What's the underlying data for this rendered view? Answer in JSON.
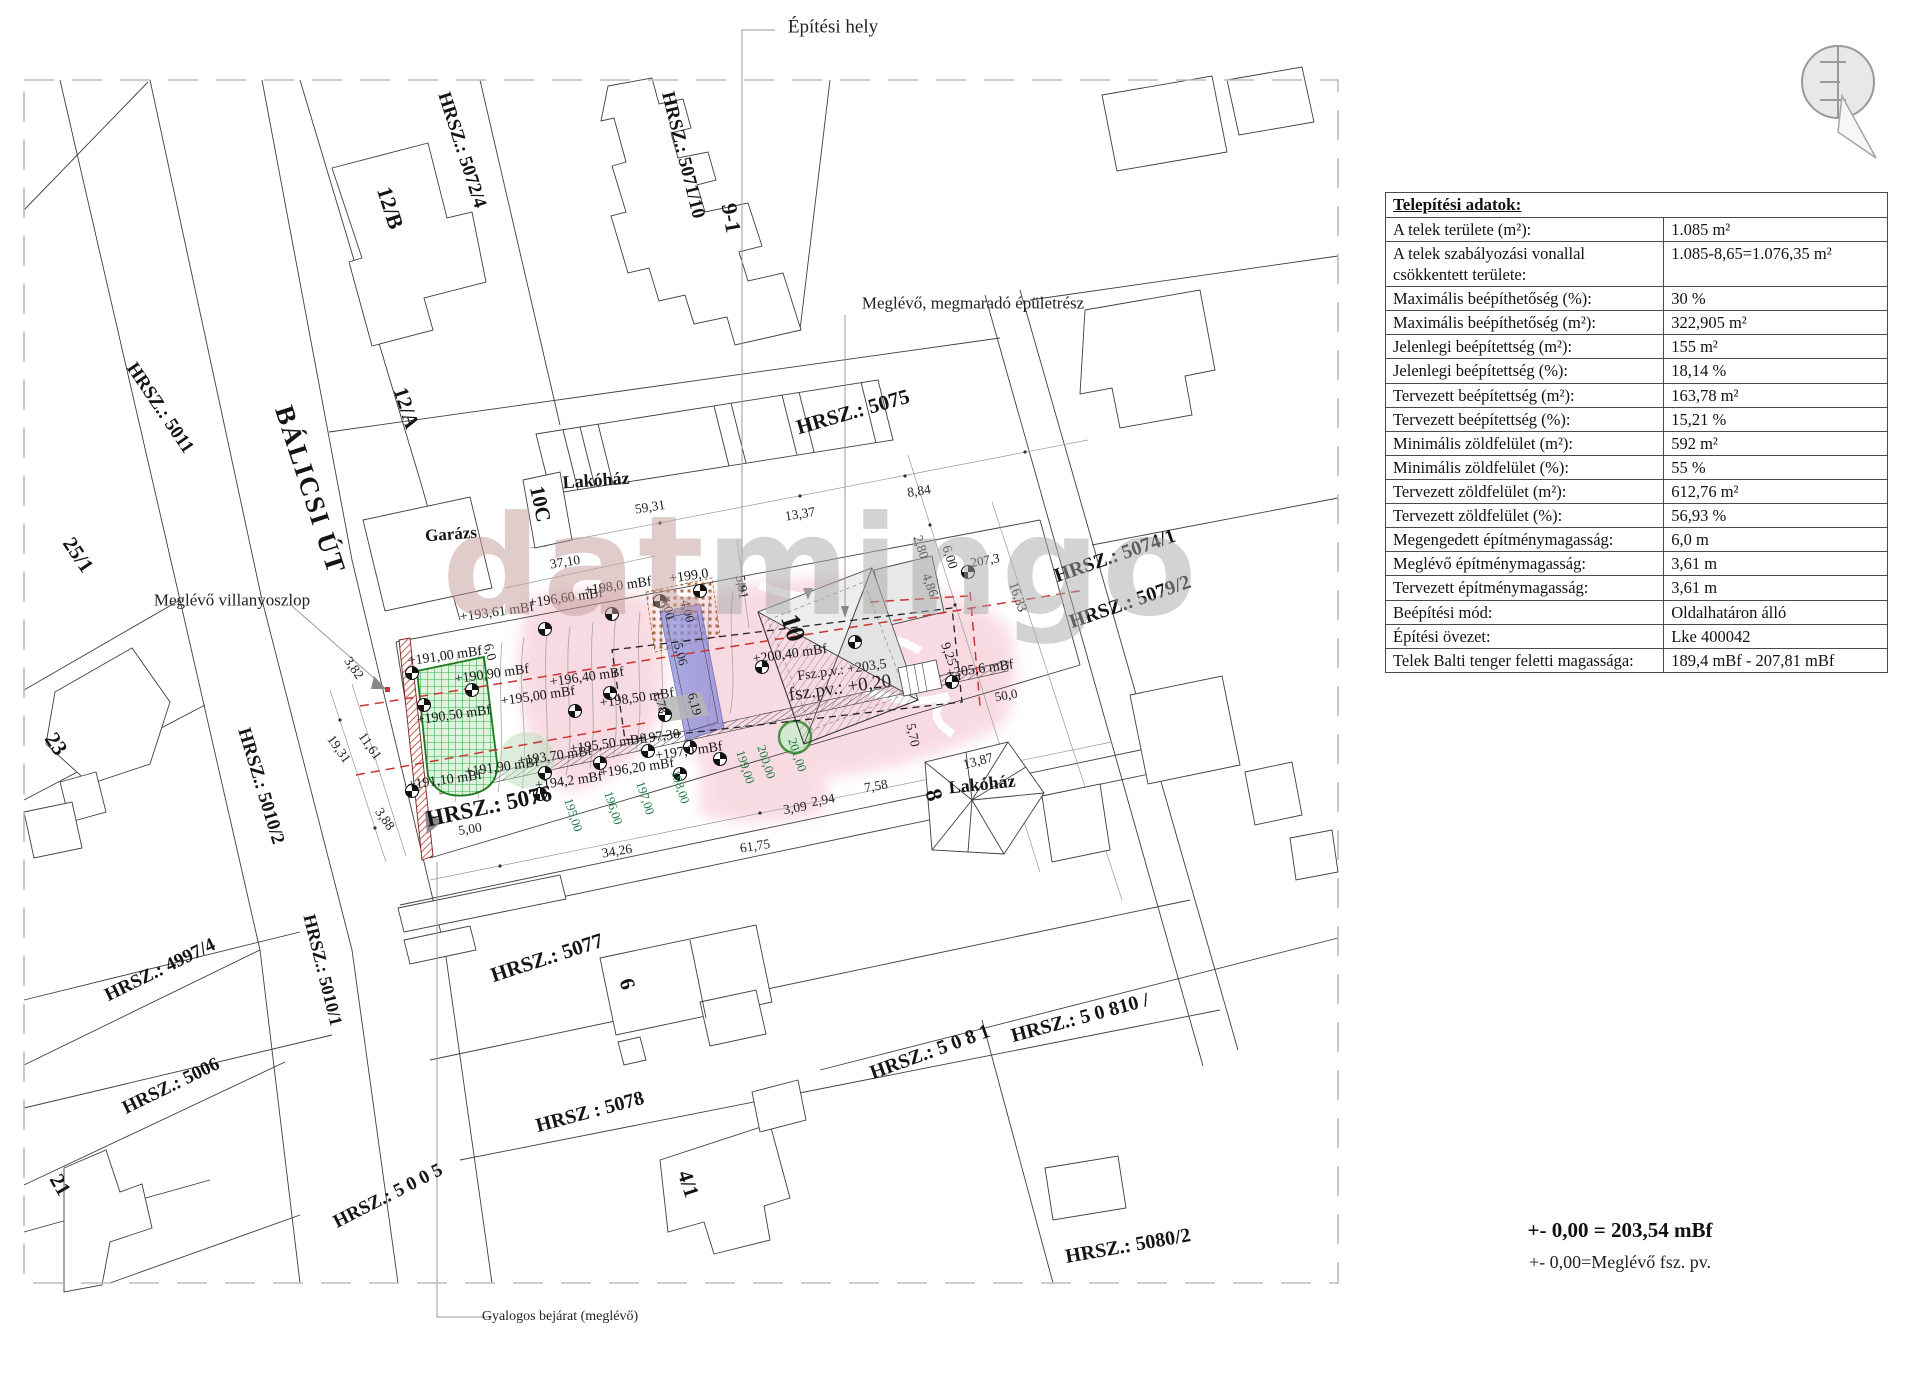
{
  "page": {
    "width": 1920,
    "height": 1376,
    "background": "#ffffff"
  },
  "colors": {
    "pink_zone": "#f3b9c6",
    "pool_blue": "#8c8cd9",
    "green_grid": "#2fae4a",
    "green_bg": "#dff3df",
    "wall_red": "#c0392b",
    "red_dash": "#cc3333",
    "contour_green": "#1e7a46",
    "watermark_gray": "#a8a8a8",
    "watermark_red": "#c49a9a",
    "line_gray": "#3f3f3f"
  },
  "watermark": {
    "part1": "dat",
    "part2": "mingo"
  },
  "footer": {
    "line1": "+- 0,00 = 203,54 mBf",
    "line2": "+- 0,00=Meglévő fsz. pv."
  },
  "table": {
    "title": "Telepítési adatok:",
    "rows": [
      {
        "label": "A telek területe (m²):",
        "value": "1.085 m²"
      },
      {
        "label": "A telek szabályozási vonallal csökkentett területe:",
        "value": "1.085-8,65=1.076,35 m²"
      },
      {
        "label": "Maximális beépíthetőség (%):",
        "value": "30 %"
      },
      {
        "label": "Maximális beépíthetőség (m²):",
        "value": "322,905 m²"
      },
      {
        "label": "Jelenlegi beépítettség (m²):",
        "value": "155 m²"
      },
      {
        "label": "Jelenlegi beépítettség (%):",
        "value": "18,14 %"
      },
      {
        "label": "Tervezett beépítettség (m²):",
        "value": "163,78 m²"
      },
      {
        "label": "Tervezett beépítettség (%):",
        "value": "15,21 %"
      },
      {
        "label": "Minimális zöldfelület (m²):",
        "value": "592 m²"
      },
      {
        "label": "Minimális zöldfelület (%):",
        "value": "55 %"
      },
      {
        "label": "Tervezett zöldfelület (m²):",
        "value": "612,76 m²"
      },
      {
        "label": "Tervezett zöldfelület (%):",
        "value": "56,93 %"
      },
      {
        "label": "Megengedett építménymagasság:",
        "value": "6,0 m"
      },
      {
        "label": "Meglévő építménymagasság:",
        "value": "3,61 m"
      },
      {
        "label": "Tervezett építménymagasság:",
        "value": "3,61 m"
      },
      {
        "label": "Beépítési mód:",
        "value": "Oldalhatáron álló"
      },
      {
        "label": "Építési övezet:",
        "value": "Lke 400042"
      },
      {
        "label": "Telek Balti tenger feletti magassága:",
        "value": "189,4 mBf  - 207,81 mBf"
      }
    ]
  },
  "map": {
    "parcel_labels": [
      {
        "t": "HRSZ.: 5072/4",
        "x": 462,
        "y": 150,
        "r": 72,
        "s": 19
      },
      {
        "t": "12/B",
        "x": 390,
        "y": 208,
        "r": 72,
        "s": 22
      },
      {
        "t": "HRSZ.: 5071/10",
        "x": 683,
        "y": 155,
        "r": 76,
        "s": 19
      },
      {
        "t": "9-1",
        "x": 731,
        "y": 218,
        "r": 80,
        "s": 22
      },
      {
        "t": "HRSZ.: 5011",
        "x": 160,
        "y": 408,
        "r": 56,
        "s": 19
      },
      {
        "t": "BÁLICSI ÚT",
        "x": 310,
        "y": 490,
        "r": 72,
        "s": 27,
        "sp": 2
      },
      {
        "t": "12/A",
        "x": 406,
        "y": 408,
        "r": 72,
        "s": 21
      },
      {
        "t": "25/1",
        "x": 78,
        "y": 555,
        "r": 56,
        "s": 21
      },
      {
        "t": "23",
        "x": 56,
        "y": 744,
        "r": 56,
        "s": 22
      },
      {
        "t": "21",
        "x": 60,
        "y": 1185,
        "r": 60,
        "s": 21
      },
      {
        "t": "HRSZ.: 5075",
        "x": 853,
        "y": 412,
        "r": -16,
        "s": 21
      },
      {
        "t": "HRSZ.: 5074/1",
        "x": 1115,
        "y": 556,
        "r": -19,
        "s": 20
      },
      {
        "t": "HRSZ.: 5079/2",
        "x": 1130,
        "y": 602,
        "r": -19,
        "s": 20
      },
      {
        "t": "HRSZ.: 5010/2",
        "x": 261,
        "y": 786,
        "r": 73,
        "s": 19
      },
      {
        "t": "HRSZ.: 4997/4",
        "x": 160,
        "y": 970,
        "r": -26,
        "s": 19
      },
      {
        "t": "HRSZ.: 5010/1",
        "x": 323,
        "y": 970,
        "r": 76,
        "s": 18
      },
      {
        "t": "HRSZ.: 5006",
        "x": 171,
        "y": 1086,
        "r": -26,
        "s": 19
      },
      {
        "t": "HRSZ.: 5 0 0 5",
        "x": 388,
        "y": 1196,
        "r": -27,
        "s": 19
      },
      {
        "t": "HRSZ.: 5076",
        "x": 489,
        "y": 806,
        "r": -12,
        "s": 23
      },
      {
        "t": "HRSZ.: 5077",
        "x": 547,
        "y": 958,
        "r": -18,
        "s": 21
      },
      {
        "t": "HRSZ : 5078",
        "x": 590,
        "y": 1112,
        "r": -15,
        "s": 20
      },
      {
        "t": "6",
        "x": 627,
        "y": 984,
        "r": 72,
        "s": 21
      },
      {
        "t": "4/1",
        "x": 688,
        "y": 1184,
        "r": 72,
        "s": 21
      },
      {
        "t": "HRSZ.: 5 0 8 1",
        "x": 930,
        "y": 1052,
        "r": -20,
        "s": 20
      },
      {
        "t": "HRSZ.: 5 0 810 /",
        "x": 1080,
        "y": 1018,
        "r": -15,
        "s": 20
      },
      {
        "t": "HRSZ.: 5080/2",
        "x": 1128,
        "y": 1246,
        "r": -10,
        "s": 20
      },
      {
        "t": "Lakóház",
        "x": 596,
        "y": 480,
        "r": -4,
        "s": 18
      },
      {
        "t": "Garázs",
        "x": 451,
        "y": 534,
        "r": -4,
        "s": 17
      },
      {
        "t": "10C",
        "x": 540,
        "y": 504,
        "r": 78,
        "s": 21
      },
      {
        "t": "Lakóház",
        "x": 982,
        "y": 784,
        "r": -6,
        "s": 18
      },
      {
        "t": "8",
        "x": 934,
        "y": 795,
        "r": 74,
        "s": 23
      },
      {
        "t": "10",
        "x": 793,
        "y": 628,
        "r": 72,
        "s": 27
      }
    ],
    "annotations": [
      {
        "t": "Építési hely",
        "x": 833,
        "y": 27,
        "s": 19
      },
      {
        "t": "Meglévő, megmaradó épületrész",
        "x": 973,
        "y": 303,
        "s": 17
      },
      {
        "t": "Meglévő villanyoszlop",
        "x": 232,
        "y": 600,
        "s": 17
      },
      {
        "t": "Gyalogos bejárat (meglévő)",
        "x": 560,
        "y": 1317,
        "s": 14
      },
      {
        "t": "Fsz.p.v.: +203,5",
        "x": 842,
        "y": 671,
        "r": -8,
        "s": 14
      },
      {
        "t": "fsz.pv.: +0,20",
        "x": 840,
        "y": 688,
        "r": -8,
        "s": 19
      }
    ],
    "elevations": [
      {
        "t": "+193,61 mBf",
        "x": 497,
        "y": 613,
        "r": -8,
        "s": 14
      },
      {
        "t": "+196,60 mBf",
        "x": 566,
        "y": 599,
        "r": -8,
        "s": 14
      },
      {
        "t": "+198,0 mBf",
        "x": 618,
        "y": 587,
        "r": -8,
        "s": 14
      },
      {
        "t": "+199,0",
        "x": 689,
        "y": 577,
        "r": -8,
        "s": 14
      },
      {
        "t": "+191,00 mBf",
        "x": 445,
        "y": 657,
        "r": -8,
        "s": 14
      },
      {
        "t": "+190,90 mBf",
        "x": 492,
        "y": 675,
        "r": -8,
        "s": 14
      },
      {
        "t": "+195,00 mBf",
        "x": 538,
        "y": 697,
        "r": -8,
        "s": 14
      },
      {
        "t": "+196,40 mBf",
        "x": 587,
        "y": 678,
        "r": -8,
        "s": 14
      },
      {
        "t": "+198,50 mBf",
        "x": 637,
        "y": 699,
        "r": -8,
        "s": 14
      },
      {
        "t": "+190,50 mBf",
        "x": 454,
        "y": 716,
        "r": -8,
        "s": 14
      },
      {
        "t": "+200,40 mBf",
        "x": 790,
        "y": 655,
        "r": -8,
        "s": 14
      },
      {
        "t": "+205,6 mBf",
        "x": 980,
        "y": 670,
        "r": -8,
        "s": 14
      },
      {
        "t": "+195,50 mBf",
        "x": 607,
        "y": 745,
        "r": -8,
        "s": 14
      },
      {
        "t": "+193,70 mBf",
        "x": 555,
        "y": 757,
        "r": -8,
        "s": 14
      },
      {
        "t": "+191,90 mBf",
        "x": 502,
        "y": 768,
        "r": -8,
        "s": 14
      },
      {
        "t": "+191,10 mBf",
        "x": 445,
        "y": 781,
        "r": -8,
        "s": 14
      },
      {
        "t": "+194,2 mBf",
        "x": 569,
        "y": 782,
        "r": -8,
        "s": 14
      },
      {
        "t": "+196,20 mBf",
        "x": 637,
        "y": 769,
        "r": -8,
        "s": 14
      },
      {
        "t": "+197,0 mBf",
        "x": 689,
        "y": 752,
        "r": -8,
        "s": 14
      },
      {
        "t": "+197,30",
        "x": 657,
        "y": 738,
        "r": -8,
        "s": 14
      },
      {
        "t": "207,3",
        "x": 985,
        "y": 560,
        "r": -10,
        "s": 13
      }
    ],
    "dimensions": [
      {
        "t": "59,31",
        "x": 650,
        "y": 507,
        "r": -9,
        "s": 13.5
      },
      {
        "t": "37,10",
        "x": 565,
        "y": 562,
        "r": -9,
        "s": 13.5
      },
      {
        "t": "13,37",
        "x": 800,
        "y": 514,
        "r": -9,
        "s": 13.5
      },
      {
        "t": "8,84",
        "x": 919,
        "y": 491,
        "r": -9,
        "s": 13.5
      },
      {
        "t": "2,80",
        "x": 921,
        "y": 547,
        "r": 72,
        "s": 13.5
      },
      {
        "t": "6,00",
        "x": 950,
        "y": 557,
        "r": 72,
        "s": 13.5
      },
      {
        "t": "4,86",
        "x": 930,
        "y": 585,
        "r": 70,
        "s": 13.5
      },
      {
        "t": "16,33",
        "x": 1018,
        "y": 597,
        "r": 70,
        "s": 13.5
      },
      {
        "t": "9,25",
        "x": 949,
        "y": 654,
        "r": 70,
        "s": 13.5
      },
      {
        "t": "5,70",
        "x": 913,
        "y": 735,
        "r": 78,
        "s": 13.5
      },
      {
        "t": "13,87",
        "x": 978,
        "y": 761,
        "r": -15,
        "s": 13.5
      },
      {
        "t": "7,58",
        "x": 876,
        "y": 786,
        "r": -10,
        "s": 13.5
      },
      {
        "t": "3,09",
        "x": 795,
        "y": 808,
        "r": -10,
        "s": 13.5
      },
      {
        "t": "2,94",
        "x": 823,
        "y": 800,
        "r": -10,
        "s": 13.5
      },
      {
        "t": "61,75",
        "x": 755,
        "y": 846,
        "r": -9,
        "s": 13.5
      },
      {
        "t": "34,26",
        "x": 617,
        "y": 851,
        "r": -9,
        "s": 13.5
      },
      {
        "t": "5,00",
        "x": 470,
        "y": 829,
        "r": -9,
        "s": 13.5
      },
      {
        "t": "50,0",
        "x": 1006,
        "y": 695,
        "r": -10,
        "s": 13
      },
      {
        "t": "5,91",
        "x": 742,
        "y": 587,
        "r": 80,
        "s": 13.5
      },
      {
        "t": "6,0",
        "x": 490,
        "y": 652,
        "r": 75,
        "s": 13.5
      },
      {
        "t": "3,82",
        "x": 354,
        "y": 668,
        "r": 55,
        "s": 13.5
      },
      {
        "t": "11,61",
        "x": 370,
        "y": 746,
        "r": 55,
        "s": 13.5
      },
      {
        "t": "19,31",
        "x": 339,
        "y": 749,
        "r": 55,
        "s": 13.5
      },
      {
        "t": "3,88",
        "x": 385,
        "y": 819,
        "r": 55,
        "s": 13.5
      },
      {
        "t": "4,00",
        "x": 668,
        "y": 608,
        "r": 75,
        "s": 13
      },
      {
        "t": "4,00",
        "x": 688,
        "y": 611,
        "r": 75,
        "s": 13
      },
      {
        "t": "5,06",
        "x": 681,
        "y": 654,
        "r": 75,
        "s": 13
      },
      {
        "t": "6,19",
        "x": 695,
        "y": 704,
        "r": 75,
        "s": 13
      },
      {
        "t": "1,78",
        "x": 661,
        "y": 702,
        "r": 75,
        "s": 13
      }
    ],
    "contour_labels": [
      {
        "t": "195,00",
        "x": 573,
        "y": 815,
        "r": 72,
        "s": 12.5
      },
      {
        "t": "196,00",
        "x": 613,
        "y": 808,
        "r": 72,
        "s": 12.5
      },
      {
        "t": "197,00",
        "x": 645,
        "y": 798,
        "r": 72,
        "s": 12.5
      },
      {
        "t": "198,00",
        "x": 680,
        "y": 787,
        "r": 72,
        "s": 12.5
      },
      {
        "t": "199,00",
        "x": 745,
        "y": 767,
        "r": 72,
        "s": 12.5
      },
      {
        "t": "200,00",
        "x": 766,
        "y": 762,
        "r": 72,
        "s": 12.5
      },
      {
        "t": "201,00",
        "x": 797,
        "y": 755,
        "r": 72,
        "s": 12.5
      }
    ],
    "survey_points": [
      {
        "x": 545,
        "y": 629
      },
      {
        "x": 612,
        "y": 614
      },
      {
        "x": 660,
        "y": 601
      },
      {
        "x": 700,
        "y": 591
      },
      {
        "x": 412,
        "y": 673
      },
      {
        "x": 472,
        "y": 690
      },
      {
        "x": 575,
        "y": 711
      },
      {
        "x": 610,
        "y": 693
      },
      {
        "x": 665,
        "y": 715
      },
      {
        "x": 424,
        "y": 705
      },
      {
        "x": 762,
        "y": 667
      },
      {
        "x": 952,
        "y": 682
      },
      {
        "x": 648,
        "y": 751
      },
      {
        "x": 600,
        "y": 763
      },
      {
        "x": 545,
        "y": 773
      },
      {
        "x": 412,
        "y": 791
      },
      {
        "x": 540,
        "y": 794
      },
      {
        "x": 680,
        "y": 774
      },
      {
        "x": 720,
        "y": 759
      },
      {
        "x": 690,
        "y": 747
      },
      {
        "x": 968,
        "y": 572
      },
      {
        "x": 855,
        "y": 642
      }
    ]
  }
}
